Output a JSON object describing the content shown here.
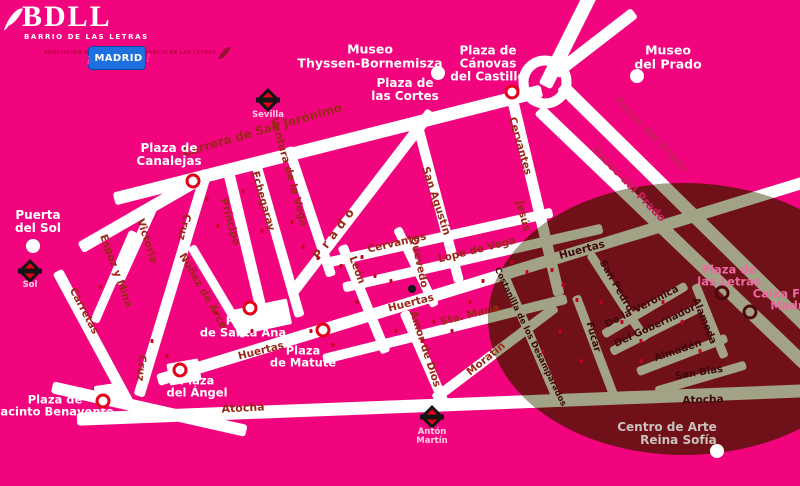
{
  "branding": {
    "logo": {
      "title": "BDLL",
      "subtitle": "BARRIO DE LAS LETRAS"
    },
    "association": {
      "lines": [
        "ASOCIACIÓN DE",
        "COMERCIANTES",
        "BARRIO DE LAS LETRAS"
      ]
    },
    "madrid_badge": {
      "prefix": "¡",
      "text": "MADRID",
      "suffix": "!"
    }
  },
  "map": {
    "colors": {
      "background": "#F2047E",
      "street": "#FFFFFF",
      "district_overlay": "#701119",
      "district_street": "#A2A386",
      "street_label": "#9B2718",
      "paseo_label": "#C81E5A",
      "district_label": "#3F070C",
      "place_label": "#FFFFFF",
      "pink_label": "#EE6AA2",
      "grey_label": "#C9C2BA",
      "metro_red": "#E3001B",
      "ring_marker": "#E30019"
    },
    "overlay_ellipse": {
      "left": 488,
      "top": 183,
      "width": 392,
      "height": 272
    },
    "roundabout": {
      "name": "Plaza de Cánovas roundabout",
      "x": 545,
      "y": 82
    },
    "streets": [
      {
        "name": "Carrera de San Jerónimo",
        "x1": 120,
        "y1": 197,
        "x2": 535,
        "y2": 92,
        "w": 13
      },
      {
        "name": "Puerta del Sol link",
        "x1": 85,
        "y1": 245,
        "x2": 196,
        "y2": 181,
        "w": 12
      },
      {
        "name": "Cruz",
        "x1": 205,
        "y1": 175,
        "x2": 140,
        "y2": 390,
        "w": 11
      },
      {
        "name": "Victoria",
        "x1": 152,
        "y1": 210,
        "x2": 120,
        "y2": 280,
        "w": 9
      },
      {
        "name": "Espoz y Mina",
        "x1": 132,
        "y1": 235,
        "x2": 96,
        "y2": 318,
        "w": 9
      },
      {
        "name": "Carretas",
        "x1": 60,
        "y1": 276,
        "x2": 128,
        "y2": 402,
        "w": 11
      },
      {
        "name": "Núñez de Arce",
        "x1": 193,
        "y1": 250,
        "x2": 242,
        "y2": 332,
        "w": 9
      },
      {
        "name": "Príncipe",
        "x1": 228,
        "y1": 169,
        "x2": 264,
        "y2": 320,
        "w": 11
      },
      {
        "name": "Echegaray",
        "x1": 255,
        "y1": 162,
        "x2": 298,
        "y2": 312,
        "w": 10
      },
      {
        "name": "Ventura de la Vega",
        "x1": 290,
        "y1": 152,
        "x2": 330,
        "y2": 272,
        "w": 10
      },
      {
        "name": "Prado",
        "x1": 296,
        "y1": 288,
        "x2": 428,
        "y2": 116,
        "w": 11
      },
      {
        "name": "León",
        "x1": 344,
        "y1": 250,
        "x2": 384,
        "y2": 348,
        "w": 10
      },
      {
        "name": "Amor de Dios",
        "x1": 406,
        "y1": 316,
        "x2": 442,
        "y2": 398,
        "w": 10
      },
      {
        "name": "San Agustín",
        "x1": 418,
        "y1": 126,
        "x2": 458,
        "y2": 277,
        "w": 10
      },
      {
        "name": "Quevedo",
        "x1": 399,
        "y1": 232,
        "x2": 433,
        "y2": 302,
        "w": 9
      },
      {
        "name": "Cervantes-Jesús",
        "x1": 512,
        "y1": 97,
        "x2": 558,
        "y2": 290,
        "w": 11
      },
      {
        "name": "Cervantes",
        "x1": 328,
        "y1": 262,
        "x2": 548,
        "y2": 213,
        "w": 10
      },
      {
        "name": "Lope de Vega",
        "x1": 348,
        "y1": 286,
        "x2": 598,
        "y2": 229,
        "w": 10
      },
      {
        "name": "Huertas",
        "x1": 163,
        "y1": 378,
        "x2": 800,
        "y2": 183,
        "w": 12
      },
      {
        "name": "Sta. María",
        "x1": 328,
        "y1": 358,
        "x2": 562,
        "y2": 300,
        "w": 10
      },
      {
        "name": "Moratín",
        "x1": 438,
        "y1": 396,
        "x2": 552,
        "y2": 310,
        "w": 10
      },
      {
        "name": "Atocha",
        "x1": 83,
        "y1": 419,
        "x2": 800,
        "y2": 391,
        "w": 13
      },
      {
        "name": "Southwest band",
        "x1": 58,
        "y1": 388,
        "x2": 240,
        "y2": 429,
        "w": 12
      },
      {
        "name": "Paseo del Prado",
        "x1": 566,
        "y1": 90,
        "x2": 810,
        "y2": 330,
        "w": 13
      },
      {
        "name": "Paseo del Prado",
        "x1": 543,
        "y1": 114,
        "x2": 800,
        "y2": 360,
        "w": 13
      },
      {
        "name": "Paseo norte",
        "x1": 548,
        "y1": 80,
        "x2": 588,
        "y2": 0,
        "w": 14
      },
      {
        "name": "Paseo noreste",
        "x1": 560,
        "y1": 70,
        "x2": 630,
        "y2": 16,
        "w": 12
      },
      {
        "name": "Costanilla de los Desamparados",
        "x1": 505,
        "y1": 278,
        "x2": 556,
        "y2": 398,
        "w": 9
      },
      {
        "name": "Fúcar",
        "x1": 577,
        "y1": 300,
        "x2": 612,
        "y2": 392,
        "w": 9
      },
      {
        "name": "San Pedro",
        "x1": 592,
        "y1": 257,
        "x2": 643,
        "y2": 336,
        "w": 9
      },
      {
        "name": "De la Verónica",
        "x1": 607,
        "y1": 332,
        "x2": 683,
        "y2": 287,
        "w": 9
      },
      {
        "name": "Del Gobernador",
        "x1": 615,
        "y1": 350,
        "x2": 703,
        "y2": 306,
        "w": 9
      },
      {
        "name": "Almadén",
        "x1": 641,
        "y1": 370,
        "x2": 722,
        "y2": 339,
        "w": 9
      },
      {
        "name": "San Blas",
        "x1": 660,
        "y1": 390,
        "x2": 742,
        "y2": 366,
        "w": 9
      },
      {
        "name": "Alameda",
        "x1": 697,
        "y1": 288,
        "x2": 723,
        "y2": 353,
        "w": 9
      }
    ],
    "plaza_blocks": [
      {
        "name": "Plaza de Santa Ana",
        "x": 262,
        "y": 317,
        "w": 56,
        "h": 26,
        "r": -12
      },
      {
        "name": "Plaza del Ángel",
        "x": 184,
        "y": 372,
        "w": 32,
        "h": 22,
        "r": -10
      },
      {
        "name": "Plaza de Jacinto Benavente",
        "x": 110,
        "y": 394,
        "w": 30,
        "h": 20,
        "r": -8
      }
    ],
    "street_labels": [
      {
        "text": "Carrera de San Jerónimo",
        "x": 262,
        "y": 130,
        "r": -16,
        "s": 12,
        "c": "o"
      },
      {
        "text": "Ventura de la Vega",
        "x": 289,
        "y": 172,
        "r": 74,
        "s": 10.5,
        "c": "o"
      },
      {
        "text": "Echegaray",
        "x": 263,
        "y": 201,
        "r": 74,
        "s": 10.5,
        "c": "o"
      },
      {
        "text": "Príncipe",
        "x": 230,
        "y": 222,
        "r": 74,
        "s": 10.5,
        "c": "o"
      },
      {
        "text": "Cruz",
        "x": 184,
        "y": 227,
        "r": 104,
        "s": 10.5,
        "c": "o"
      },
      {
        "text": "Cruz",
        "x": 141,
        "y": 368,
        "r": 95,
        "s": 10.5,
        "c": "o"
      },
      {
        "text": "Victoria",
        "x": 147,
        "y": 241,
        "r": 72,
        "s": 10.5,
        "c": "o"
      },
      {
        "text": "Espoz y Mina",
        "x": 116,
        "y": 271,
        "r": 70,
        "s": 10.5,
        "c": "o"
      },
      {
        "text": "Carretas",
        "x": 84,
        "y": 311,
        "r": 62,
        "s": 10.5,
        "c": "o"
      },
      {
        "text": "Núñez de Arce",
        "x": 203,
        "y": 291,
        "r": 60,
        "s": 10.5,
        "c": "o"
      },
      {
        "text": "Prado",
        "x": 335,
        "y": 232,
        "r": -53,
        "s": 12,
        "c": "o",
        "ls": 5
      },
      {
        "text": "León",
        "x": 357,
        "y": 270,
        "r": 70,
        "s": 10.5,
        "c": "o"
      },
      {
        "text": "San Agustín",
        "x": 436,
        "y": 201,
        "r": 72,
        "s": 10.5,
        "c": "o"
      },
      {
        "text": "Cervantes",
        "x": 397,
        "y": 243,
        "r": -13,
        "s": 10.5,
        "c": "o"
      },
      {
        "text": "Quevedo",
        "x": 419,
        "y": 262,
        "r": 78,
        "s": 10.5,
        "c": "o"
      },
      {
        "text": "Lope de Vega",
        "x": 477,
        "y": 250,
        "r": -14,
        "s": 10.5,
        "c": "o"
      },
      {
        "text": "Cervantes",
        "x": 520,
        "y": 146,
        "r": 74,
        "s": 10.5,
        "c": "o"
      },
      {
        "text": "Jesús",
        "x": 523,
        "y": 216,
        "r": 76,
        "s": 10.5,
        "c": "o"
      },
      {
        "text": "Huertas",
        "x": 261,
        "y": 351,
        "r": -14,
        "s": 10.5,
        "c": "o"
      },
      {
        "text": "Huertas",
        "x": 411,
        "y": 303,
        "r": -14,
        "s": 10.5,
        "c": "o"
      },
      {
        "text": "Sta. María",
        "x": 470,
        "y": 315,
        "r": -14,
        "s": 10.5,
        "c": "o"
      },
      {
        "text": "Amor de Dios",
        "x": 425,
        "y": 349,
        "r": 72,
        "s": 10.5,
        "c": "o"
      },
      {
        "text": "Moratín",
        "x": 486,
        "y": 359,
        "r": -39,
        "s": 10.5,
        "c": "o"
      },
      {
        "text": "Atocha",
        "x": 243,
        "y": 408,
        "r": -3,
        "s": 11,
        "c": "o"
      },
      {
        "text": "Paseo del Prado",
        "x": 651,
        "y": 134,
        "r": 46,
        "s": 11,
        "c": "p"
      },
      {
        "text": "Paseo del Prado",
        "x": 629,
        "y": 184,
        "r": 46,
        "s": 11,
        "c": "p"
      },
      {
        "text": "Huertas",
        "x": 582,
        "y": 250,
        "r": -15,
        "s": 10.5,
        "c": "i"
      },
      {
        "text": "San Pedro",
        "x": 616,
        "y": 286,
        "r": 60,
        "s": 10,
        "c": "i"
      },
      {
        "text": "De la Verónica",
        "x": 642,
        "y": 307,
        "r": -27,
        "s": 10,
        "c": "i"
      },
      {
        "text": "Del Gobernador",
        "x": 655,
        "y": 326,
        "r": -25,
        "s": 10,
        "c": "i"
      },
      {
        "text": "Almadén",
        "x": 678,
        "y": 351,
        "r": -19,
        "s": 10,
        "c": "i"
      },
      {
        "text": "San Blas",
        "x": 699,
        "y": 373,
        "r": -9,
        "s": 10,
        "c": "i"
      },
      {
        "text": "Alameda",
        "x": 704,
        "y": 321,
        "r": 68,
        "s": 10,
        "c": "i"
      },
      {
        "text": "Fúcar",
        "x": 593,
        "y": 337,
        "r": 74,
        "s": 10,
        "c": "i"
      },
      {
        "text": "Costanilla de los Desamparados",
        "x": 530,
        "y": 337,
        "r": 64,
        "s": 8.5,
        "c": "i"
      },
      {
        "text": "Atocha",
        "x": 703,
        "y": 400,
        "r": -2,
        "s": 10.5,
        "c": "i"
      }
    ],
    "place_labels": [
      {
        "lines": [
          "Museo",
          "Thyssen-Bornemisza"
        ],
        "x": 370,
        "y": 56,
        "c": "white",
        "s": 12.5
      },
      {
        "lines": [
          "Plaza de",
          "las Cortes"
        ],
        "x": 405,
        "y": 90,
        "c": "white",
        "s": 12
      },
      {
        "lines": [
          "Plaza de",
          "Cánovas",
          "del Castillo"
        ],
        "x": 488,
        "y": 64,
        "c": "white",
        "s": 12
      },
      {
        "lines": [
          "Museo",
          "del Prado"
        ],
        "x": 668,
        "y": 57,
        "c": "white",
        "s": 12.5
      },
      {
        "lines": [
          "Plaza de",
          "Canalejas"
        ],
        "x": 169,
        "y": 155,
        "c": "white",
        "s": 12
      },
      {
        "lines": [
          "Puerta",
          "del Sol"
        ],
        "x": 38,
        "y": 222,
        "c": "white",
        "s": 12
      },
      {
        "lines": [
          "Plaza",
          "de Santa Ana"
        ],
        "x": 243,
        "y": 327,
        "c": "white",
        "s": 11.5
      },
      {
        "lines": [
          "Plaza",
          "del Ángel"
        ],
        "x": 197,
        "y": 387,
        "c": "white",
        "s": 11.5
      },
      {
        "lines": [
          "Plaza",
          "de Matute"
        ],
        "x": 303,
        "y": 357,
        "c": "white",
        "s": 11.5
      },
      {
        "lines": [
          "Plaza de",
          "Jacinto Benavente"
        ],
        "x": 55,
        "y": 406,
        "c": "white",
        "s": 11.5
      },
      {
        "lines": [
          "Plaza de",
          "las Letras"
        ],
        "x": 729,
        "y": 276,
        "c": "pink",
        "s": 11.5
      },
      {
        "lines": [
          "Caixa Forum",
          "Madrid"
        ],
        "x": 793,
        "y": 300,
        "c": "pink",
        "s": 11.5
      },
      {
        "lines": [
          "Centro de Arte",
          "Reina Sofía"
        ],
        "x": 667,
        "y": 434,
        "c": "grey",
        "s": 12,
        "align": "right"
      }
    ],
    "metro_stations": [
      {
        "lines": [
          "Sevilla"
        ],
        "x": 268,
        "icon_y": 100,
        "label_y": 111
      },
      {
        "lines": [
          "Sol"
        ],
        "x": 30,
        "icon_y": 271,
        "label_y": 281
      },
      {
        "lines": [
          "Antón",
          "Martín"
        ],
        "x": 432,
        "icon_y": 417,
        "label_y": 428
      }
    ],
    "poi_dots": [
      {
        "name": "Puerta del Sol",
        "x": 33,
        "y": 246
      },
      {
        "name": "Museo Thyssen-Bornemisza",
        "x": 438,
        "y": 73
      },
      {
        "name": "Museo del Prado",
        "x": 637,
        "y": 76
      },
      {
        "name": "Centro de Arte Reina Sofía",
        "x": 717,
        "y": 451
      }
    ],
    "landmark_dot": {
      "name": "Casa-museo",
      "x": 412,
      "y": 289
    },
    "ring_markers": [
      {
        "name": "Plaza de Canalejas",
        "x": 193,
        "y": 181,
        "dark": false
      },
      {
        "name": "Plaza de las Cortes",
        "x": 512,
        "y": 92,
        "dark": false
      },
      {
        "name": "Plaza de Santa Ana",
        "x": 250,
        "y": 308,
        "dark": false
      },
      {
        "name": "Plaza de Matute",
        "x": 323,
        "y": 330,
        "dark": false
      },
      {
        "name": "Plaza del Ángel",
        "x": 180,
        "y": 370,
        "dark": false
      },
      {
        "name": "Plaza de Jacinto Benavente",
        "x": 103,
        "y": 401,
        "dark": false
      },
      {
        "name": "Plaza de las Letras",
        "x": 722,
        "y": 293,
        "dark": true
      },
      {
        "name": "Caixa Forum Madrid",
        "x": 750,
        "y": 312,
        "dark": true
      }
    ],
    "shop_markers": [
      [
        207,
        199
      ],
      [
        243,
        191
      ],
      [
        218,
        226
      ],
      [
        262,
        231
      ],
      [
        292,
        222
      ],
      [
        303,
        247
      ],
      [
        318,
        258
      ],
      [
        341,
        266
      ],
      [
        362,
        257
      ],
      [
        375,
        276
      ],
      [
        391,
        281
      ],
      [
        357,
        302
      ],
      [
        311,
        331
      ],
      [
        333,
        345
      ],
      [
        396,
        331
      ],
      [
        422,
        341
      ],
      [
        434,
        322
      ],
      [
        452,
        331
      ],
      [
        470,
        302
      ],
      [
        483,
        281
      ],
      [
        512,
        262
      ],
      [
        527,
        272
      ],
      [
        552,
        270
      ],
      [
        563,
        285
      ],
      [
        577,
        300
      ],
      [
        601,
        302
      ],
      [
        622,
        322
      ],
      [
        641,
        341
      ],
      [
        663,
        302
      ],
      [
        682,
        322
      ],
      [
        560,
        331
      ],
      [
        543,
        352
      ],
      [
        581,
        361
      ],
      [
        641,
        361
      ],
      [
        700,
        351
      ],
      [
        216,
        313
      ],
      [
        252,
        331
      ],
      [
        152,
        341
      ],
      [
        167,
        356
      ],
      [
        100,
        287
      ]
    ]
  }
}
